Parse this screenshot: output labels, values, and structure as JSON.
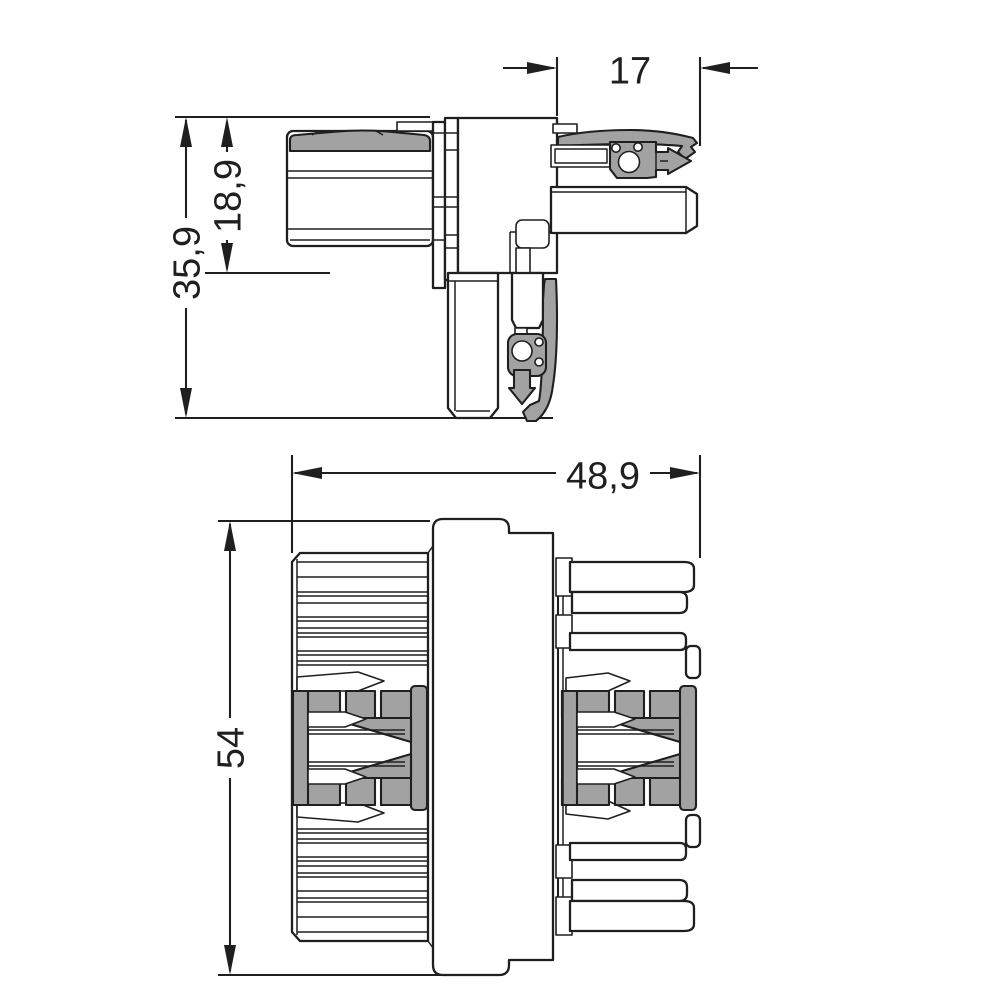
{
  "colors": {
    "background": "#ffffff",
    "line": "#1f1f1f",
    "gray_fill": "#a2a2a2"
  },
  "views": {
    "side": {
      "dimensions": {
        "section_width": "17",
        "upper_height": "18,9",
        "total_height": "35,9"
      }
    },
    "front": {
      "dimensions": {
        "total_width": "48,9",
        "total_height": "54"
      }
    }
  }
}
